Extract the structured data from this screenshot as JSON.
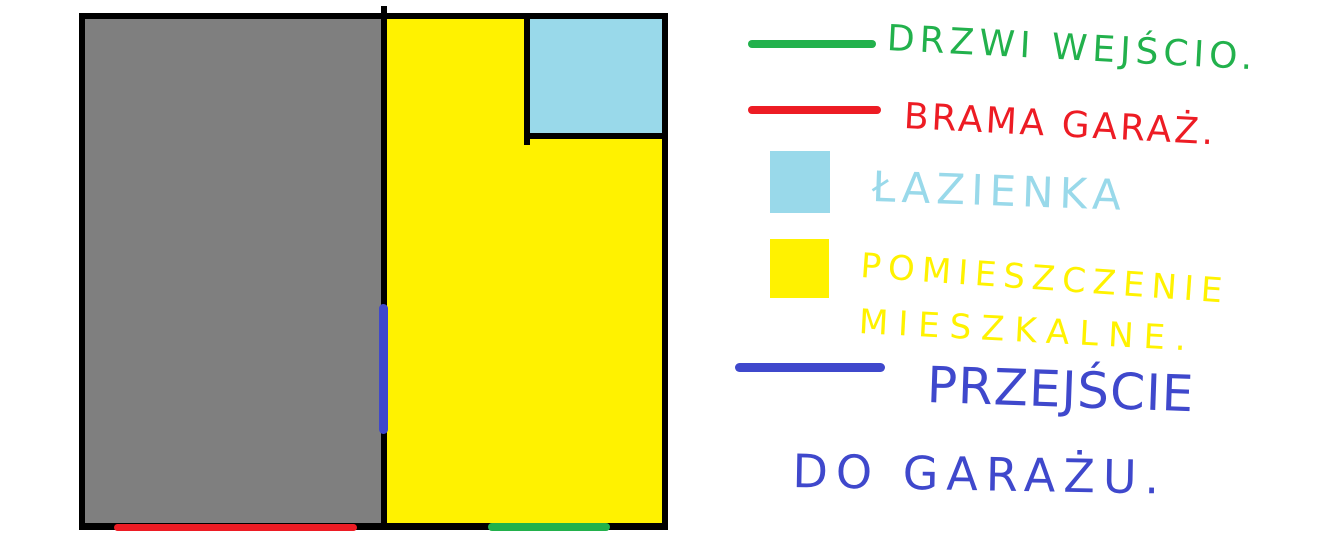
{
  "colors": {
    "wall_black": "#000000",
    "garage_gray": "#7F7F7F",
    "living_yellow": "#FFF200",
    "bathroom_blue": "#99D9EA",
    "entrance_green": "#22B14C",
    "gate_red": "#ED1C24",
    "passage_blue": "#3F48CC"
  },
  "floor_plan": {
    "garage": {
      "fill": "#7F7F7F"
    },
    "living_space": {
      "fill": "#FFF200"
    },
    "bathroom": {
      "fill": "#99D9EA"
    },
    "entrance_door": {
      "color": "#22B14C"
    },
    "garage_gate": {
      "color": "#ED1C24"
    },
    "garage_passage": {
      "color": "#3F48CC"
    }
  },
  "legend": {
    "items": [
      {
        "swatch": "line",
        "color": "#22B14C",
        "label": "DRZWI WEJŚCIO."
      },
      {
        "swatch": "line",
        "color": "#ED1C24",
        "label": "BRAMA GARAŻ."
      },
      {
        "swatch": "square",
        "color": "#99D9EA",
        "label": "ŁAZIENKA"
      },
      {
        "swatch": "square",
        "color": "#FFF200",
        "label_line1": "POMIESZCZENIE",
        "label_line2": "MIESZKALNE."
      },
      {
        "swatch": "line",
        "color": "#3F48CC",
        "label_line1": "PRZEJŚCIE",
        "label_line2": "DO GARAŻU."
      }
    ]
  }
}
